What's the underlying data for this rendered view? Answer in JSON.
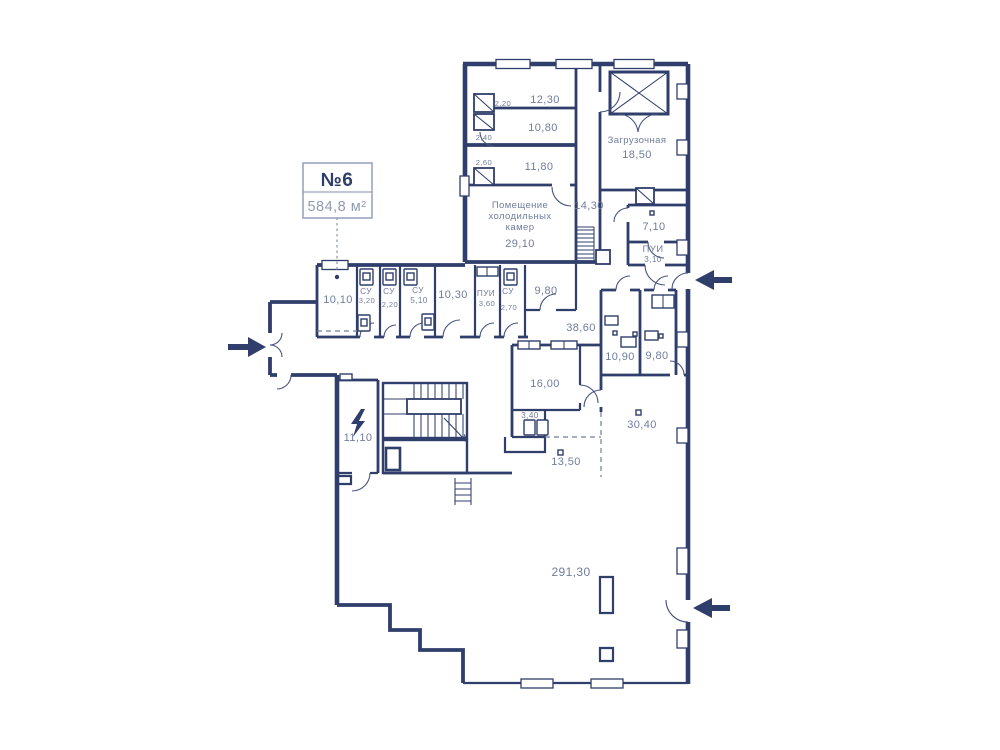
{
  "callout": {
    "number": "№6",
    "area": "584,8 м²"
  },
  "colors": {
    "wall": "#2f3e6b",
    "label": "#6f7d9e",
    "muted": "#8f9ab2",
    "background": "#ffffff"
  },
  "rooms": {
    "r1230": "12,30",
    "s220": "2,20",
    "r1080": "10,80",
    "s240": "2,40",
    "r1180": "11,80",
    "s260": "2,60",
    "zagr_name": "Загрузочная",
    "zagr_area": "18,50",
    "cold_1": "Помещение",
    "cold_2": "холодильных",
    "cold_3": "камер",
    "cold_area": "29,10",
    "r1430": "14,30",
    "r710": "7,10",
    "pui1_name": "ПУИ",
    "pui1_area": "3,10",
    "r1010": "10,10",
    "su1_name": "СУ",
    "su1_area": "3,20",
    "su2_name": "СУ",
    "su2_area": "2,20",
    "su3_name": "СУ",
    "su3_area": "5,10",
    "r1030": "10,30",
    "pui2_name": "ПУИ",
    "pui2_area": "3,60",
    "su4_name": "СУ",
    "su4_area": "2,70",
    "r980a": "9,80",
    "r3860": "38,60",
    "r1090": "10,90",
    "r980b": "9,80",
    "r1600": "16,00",
    "r340": "3,40",
    "r3040": "30,40",
    "r1350": "13,50",
    "r1110": "11,10",
    "r29130": "291,30"
  }
}
